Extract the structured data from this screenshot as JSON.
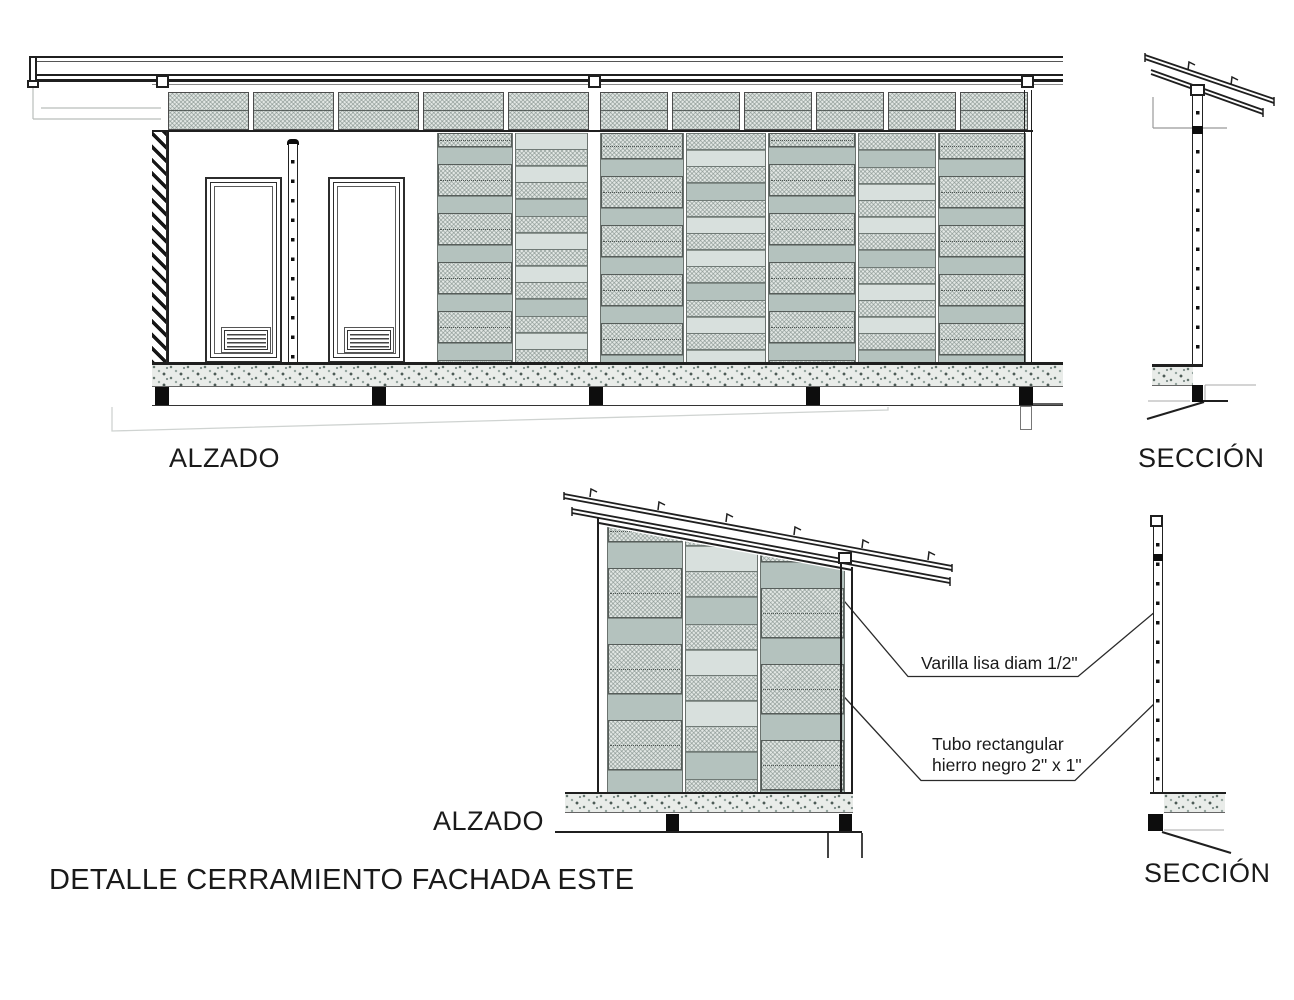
{
  "title": {
    "text": "DETALLE CERRAMIENTO FACHADA ESTE"
  },
  "labels": {
    "alzado_main": "ALZADO",
    "seccion_main": "SECCIÓN",
    "alzado_detail": "ALZADO",
    "seccion_detail": "SECCIÓN"
  },
  "annotations": {
    "varilla": "Varilla lisa diam 1/2\"",
    "tubo_line1": "Tubo rectangular",
    "tubo_line2": "hierro negro 2\" x 1\""
  },
  "theme": {
    "line-dark": "#1f1f1f",
    "line-light": "#b9bdbb",
    "hatch-base": "#e2e7e4",
    "sage-band": "#b4c2be",
    "plain-slat": "#d8e0dd",
    "concrete-base": "#e9ece9",
    "text-color": "#1a1a1a"
  }
}
